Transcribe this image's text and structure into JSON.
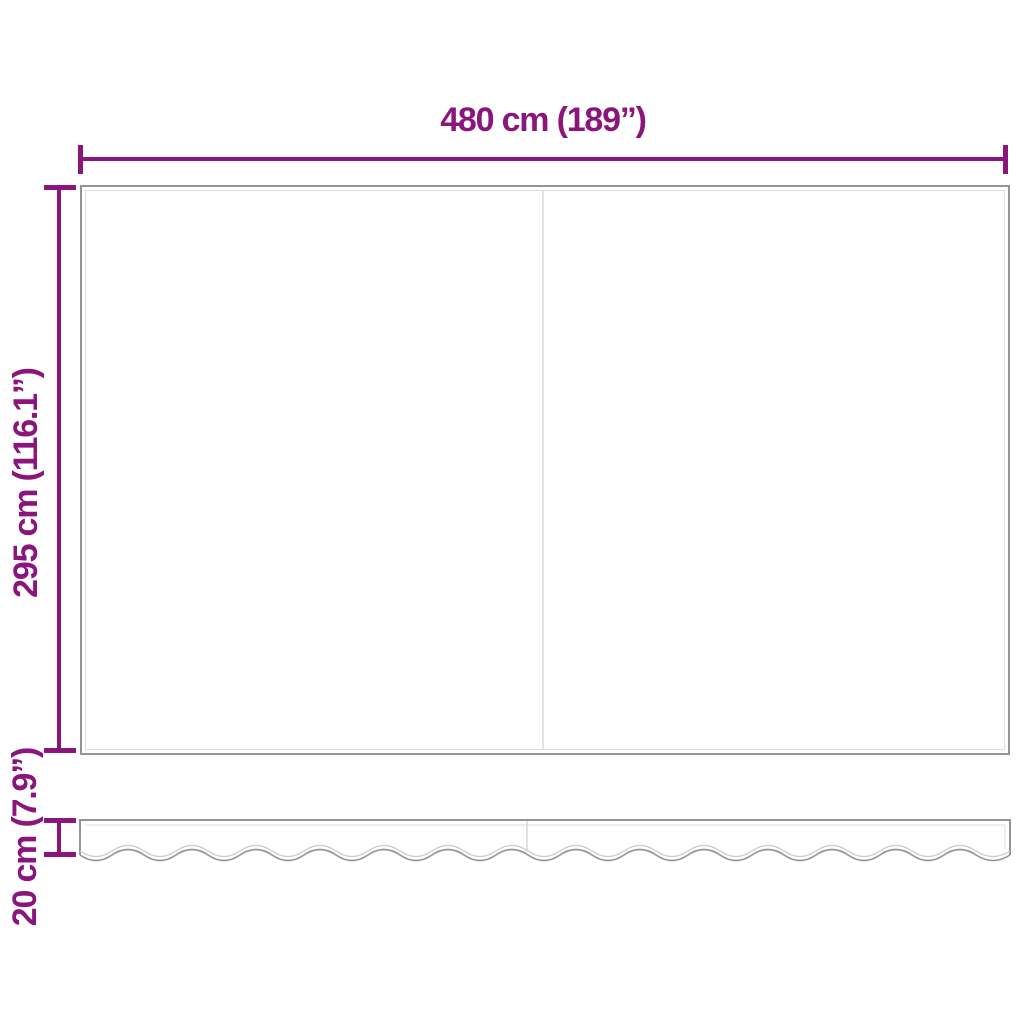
{
  "diagram": {
    "type": "product-dimension-diagram",
    "subject": "awning-replacement-fabric-with-valance",
    "top_dimension": {
      "label": "480 cm (189”)",
      "value_cm": 480,
      "value_in": 189
    },
    "side_dimension": {
      "label": "295 cm (116.1”)",
      "value_cm": 295,
      "value_in": 116.1
    },
    "valance_dimension": {
      "label": "20 cm (7.9”)",
      "value_cm": 20,
      "value_in": 7.9
    },
    "colors": {
      "dimension_accent": "#8a157c",
      "outline_gray": "#949494",
      "inner_line_gray": "#dedede",
      "divider_gray": "#e4e4e4",
      "background": "#ffffff"
    }
  }
}
